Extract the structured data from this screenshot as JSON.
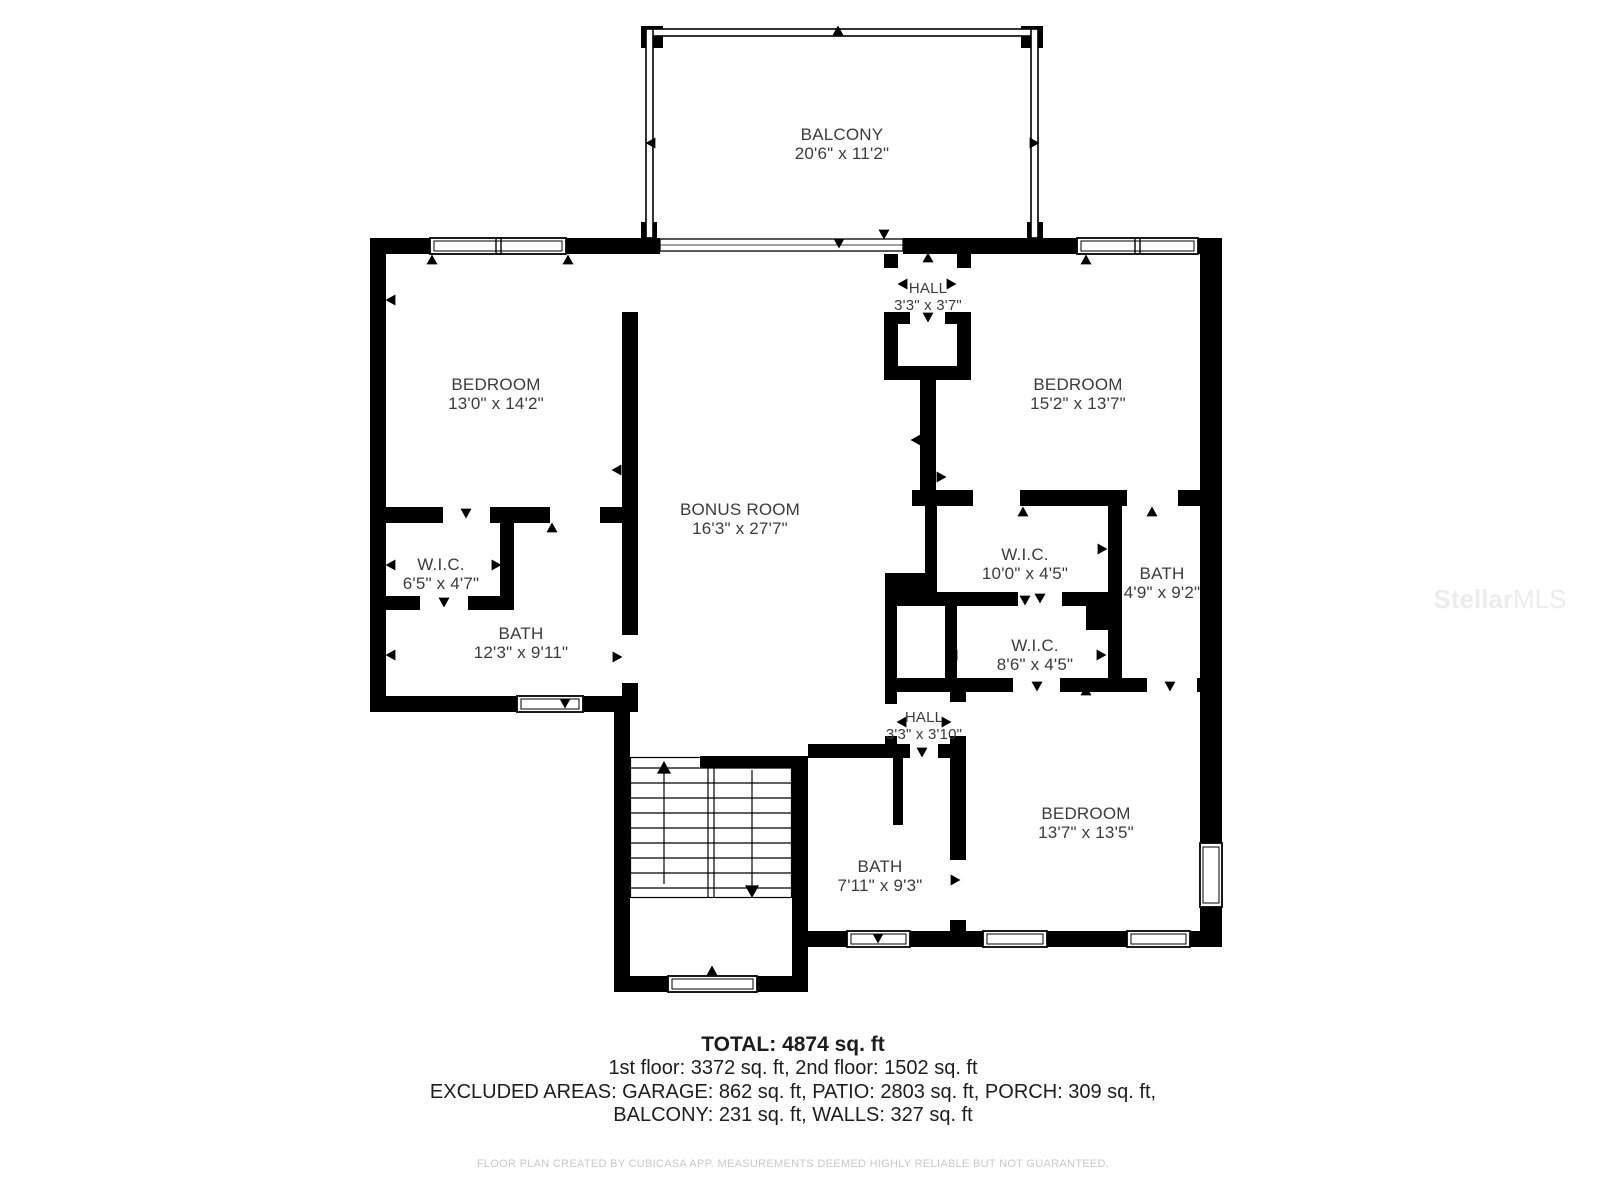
{
  "plan": {
    "rooms": [
      {
        "id": "balcony",
        "name": "BALCONY",
        "dims": "20'6\" x 11'2\""
      },
      {
        "id": "bedroom-left",
        "name": "BEDROOM",
        "dims": "13'0\" x 14'2\""
      },
      {
        "id": "hall-upper",
        "name": "HALL",
        "dims": "3'3\" x 3'7\""
      },
      {
        "id": "bedroom-right",
        "name": "BEDROOM",
        "dims": "15'2\" x 13'7\""
      },
      {
        "id": "bonus-room",
        "name": "BONUS ROOM",
        "dims": "16'3\" x 27'7\""
      },
      {
        "id": "wic-left",
        "name": "W.I.C.",
        "dims": "6'5\" x 4'7\""
      },
      {
        "id": "wic-middle",
        "name": "W.I.C.",
        "dims": "10'0\" x 4'5\""
      },
      {
        "id": "bath-right",
        "name": "BATH",
        "dims": "4'9\" x 9'2\""
      },
      {
        "id": "bath-left",
        "name": "BATH",
        "dims": "12'3\" x 9'11\""
      },
      {
        "id": "wic-lower",
        "name": "W.I.C.",
        "dims": "8'6\" x 4'5\""
      },
      {
        "id": "hall-lower",
        "name": "HALL",
        "dims": "3'3\" x 3'10\""
      },
      {
        "id": "bath-bottom",
        "name": "BATH",
        "dims": "7'11\" x 9'3\""
      },
      {
        "id": "bedroom-bottom",
        "name": "BEDROOM",
        "dims": "13'7\" x 13'5\""
      }
    ]
  },
  "summary": {
    "total": "TOTAL: 4874 sq. ft",
    "floors": "1st floor: 3372 sq. ft, 2nd floor: 1502 sq. ft",
    "excluded_1": "EXCLUDED AREAS: GARAGE: 862 sq. ft, PATIO: 2803 sq. ft, PORCH: 309 sq. ft,",
    "excluded_2": "BALCONY: 231 sq. ft, WALLS: 327 sq. ft"
  },
  "footer": {
    "disclaimer": "FLOOR PLAN CREATED BY CUBICASA APP. MEASUREMENTS DEEMED HIGHLY RELIABLE BUT NOT GUARANTEED."
  },
  "watermark": {
    "brand": "Stellar",
    "suffix": "MLS"
  },
  "colors": {
    "wall": "#000000",
    "label_text": "#3b3b3b",
    "summary_text": "#1d1d1d",
    "disclaimer_text": "#c9c9c9",
    "watermark_text": "#ececec",
    "background": "#ffffff"
  }
}
